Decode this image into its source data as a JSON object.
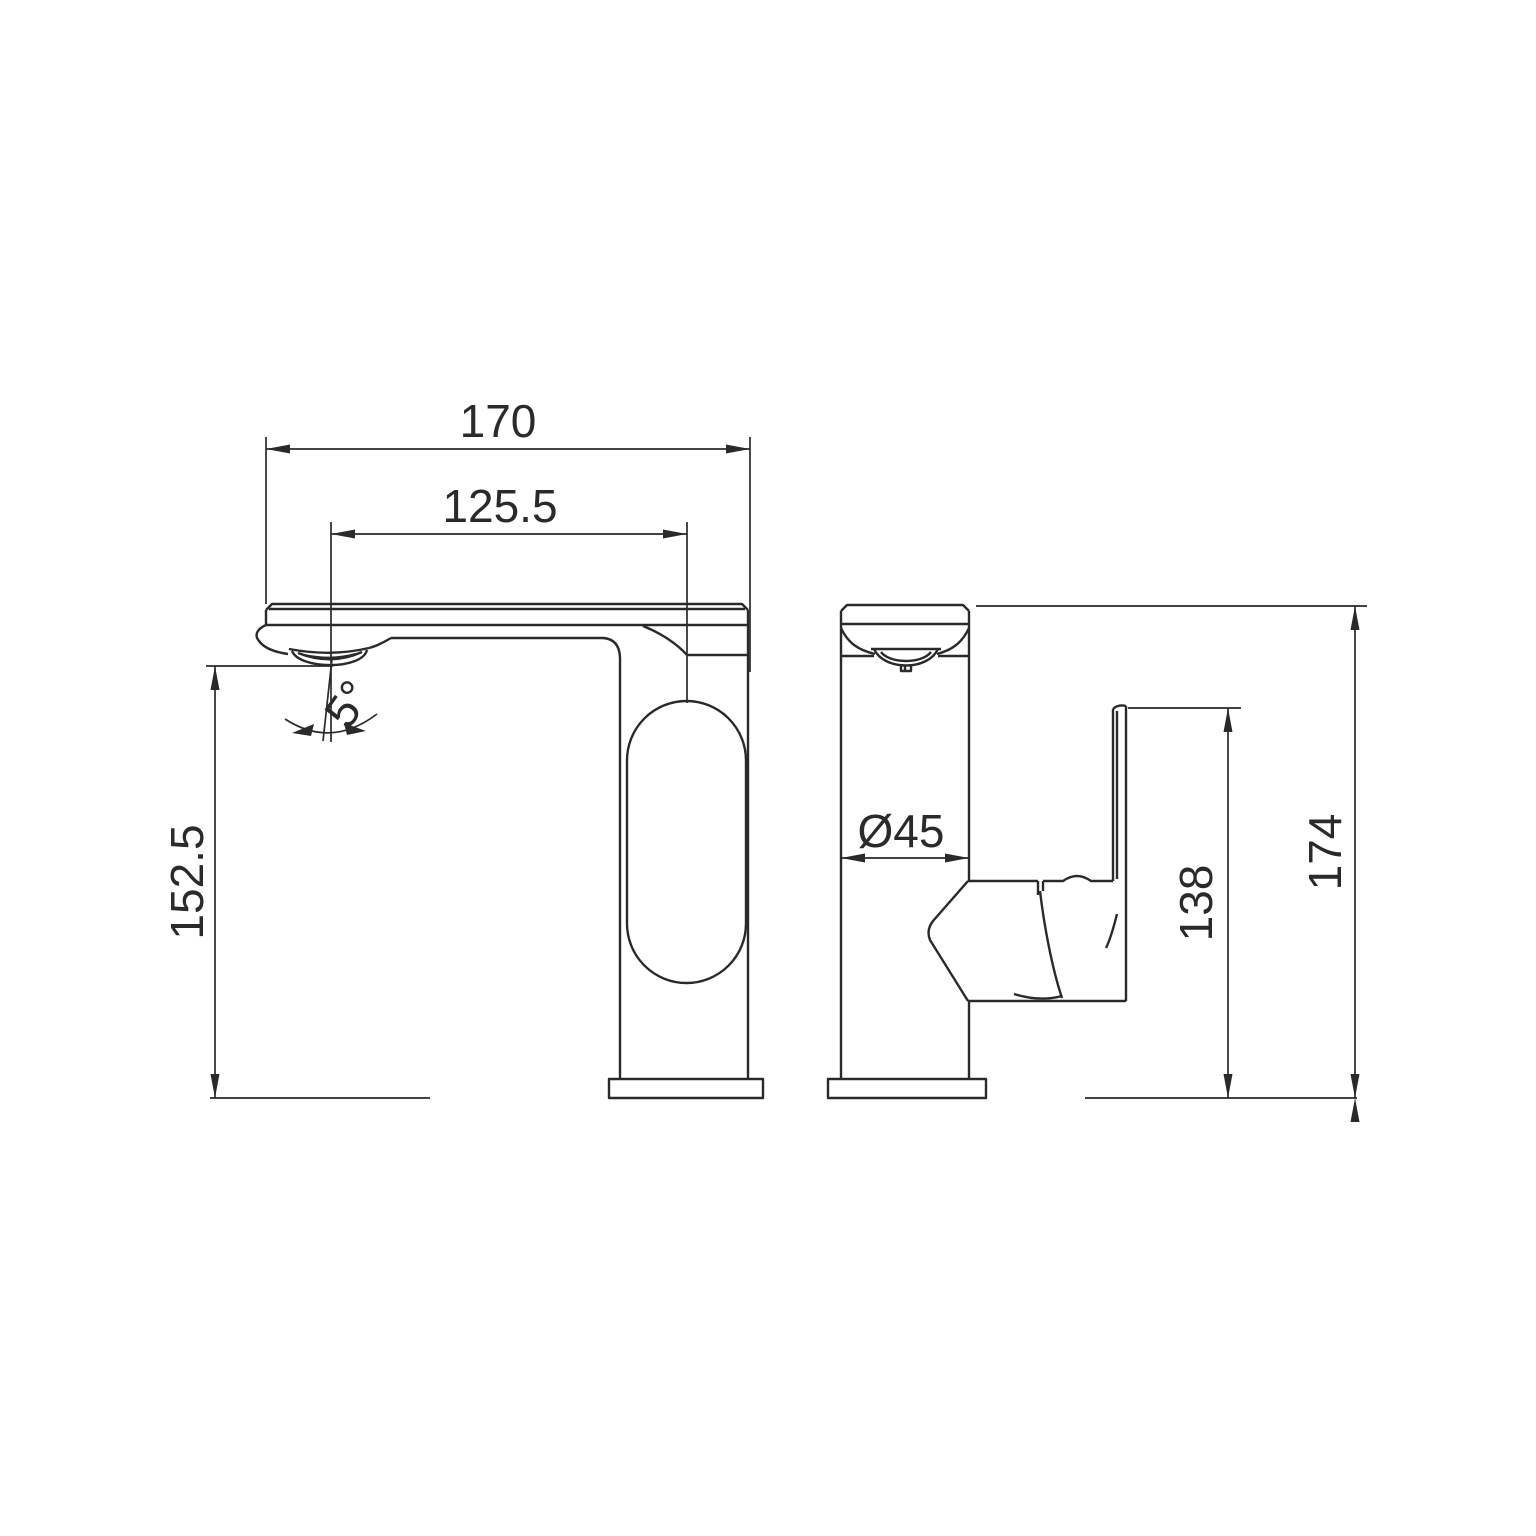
{
  "drawing": {
    "type": "technical-drawing",
    "subject": "single-lever basin mixer faucet, front and side orthographic views with dimensions",
    "units": "mm",
    "colors": {
      "line": "#2a2a2a",
      "background": "#ffffff"
    },
    "dims": {
      "front_width": {
        "label": "170"
      },
      "spout_reach": {
        "label": "125.5"
      },
      "spout_outlet_height": {
        "label": "152.5"
      },
      "spout_angle": {
        "label": "5°"
      },
      "body_diameter": {
        "label": "Ø45"
      },
      "handle_top_height": {
        "label": "138"
      },
      "overall_height": {
        "label": "174"
      }
    }
  }
}
